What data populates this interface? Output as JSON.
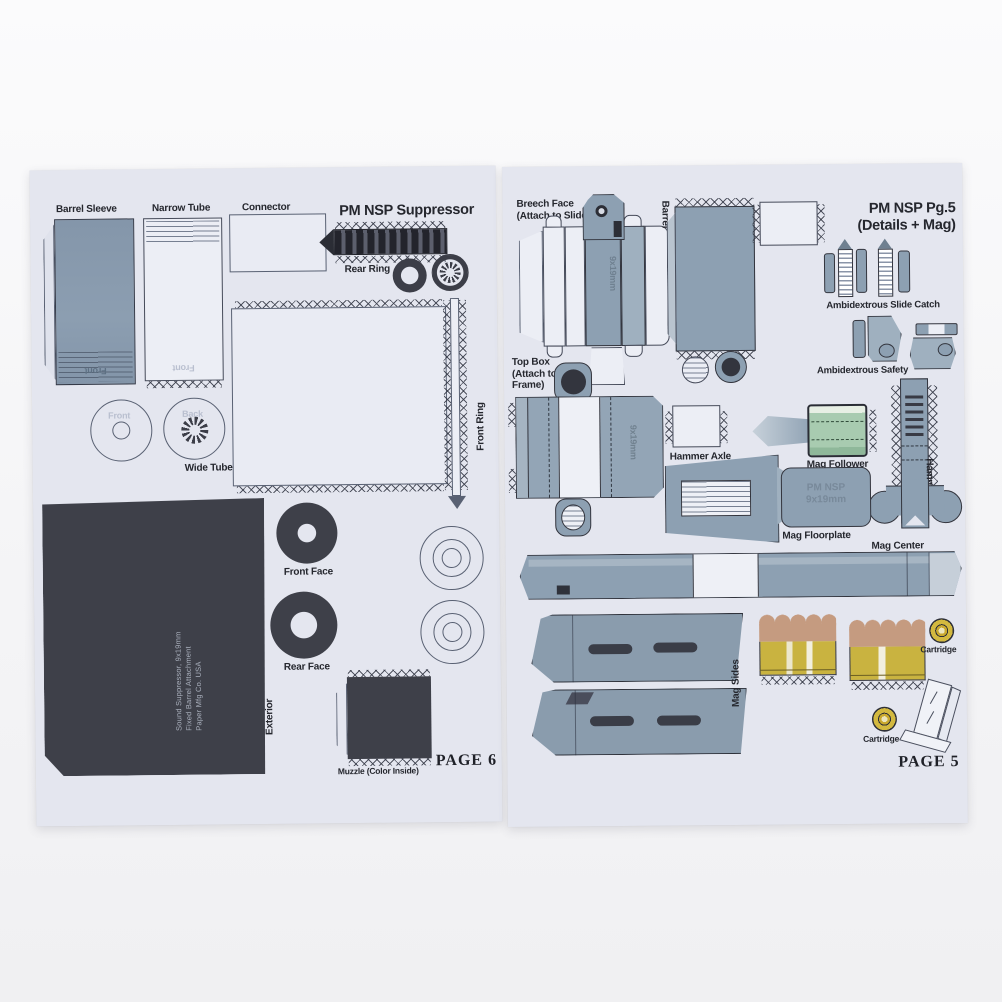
{
  "colors": {
    "paper": "#e4e6ef",
    "steel_blue": "#8da0b2",
    "ink": "#25272e",
    "dark_part": "#3e4049",
    "mag_follower_green": "#a8cbb0",
    "cartridge_brass": "#c9b340",
    "bullet_tan": "#c59b80"
  },
  "left_page": {
    "title": "PM NSP Suppressor",
    "page_number": "PAGE 6",
    "labels": {
      "barrel_sleeve": "Barrel Sleeve",
      "narrow_tube": "Narrow Tube",
      "connector": "Connector",
      "rear_ring": "Rear Ring",
      "front_ring": "Front Ring",
      "wide_tube": "Wide Tube",
      "front_circle": "Front",
      "back_circle": "Back",
      "sleeve_marking": "Front",
      "tube_marking": "Front",
      "front_face": "Front Face",
      "rear_face": "Rear Face",
      "exterior": "Exterior",
      "muzzle": "Muzzle (Color Inside)"
    },
    "exterior_text": {
      "line1": "Sound Suppressor, 9x19mm",
      "line2": "Fixed Barrel Attachment",
      "line3": "Paper Mfg Co. USA"
    }
  },
  "right_page": {
    "title_line1": "PM NSP Pg.5",
    "title_line2": "(Details + Mag)",
    "page_number": "PAGE 5",
    "labels": {
      "breech_line1": "Breech Face",
      "breech_line2": "(Attach to Slide)",
      "barrel": "Barrel",
      "slide_catch": "Ambidextrous Slide Catch",
      "safety": "Ambidextrous Safety",
      "top_box_line1": "Top Box",
      "top_box_line2": "(Attach to",
      "top_box_line3": "Frame)",
      "hammer_axle": "Hammer Axle",
      "mag_follower": "Mag Follower",
      "hammer": "Hammer",
      "mag_floorplate": "Mag Floorplate",
      "mag_center": "Mag Center",
      "mag_sides": "Mag Sides",
      "cartridge_a": "Cartridge",
      "cartridge_b": "Cartridge"
    },
    "markings": {
      "breech_caliber": "9x19mm",
      "topbox_caliber": "9x19mm",
      "floorplate_line1": "PM NSP",
      "floorplate_line2": "9x19mm"
    }
  }
}
